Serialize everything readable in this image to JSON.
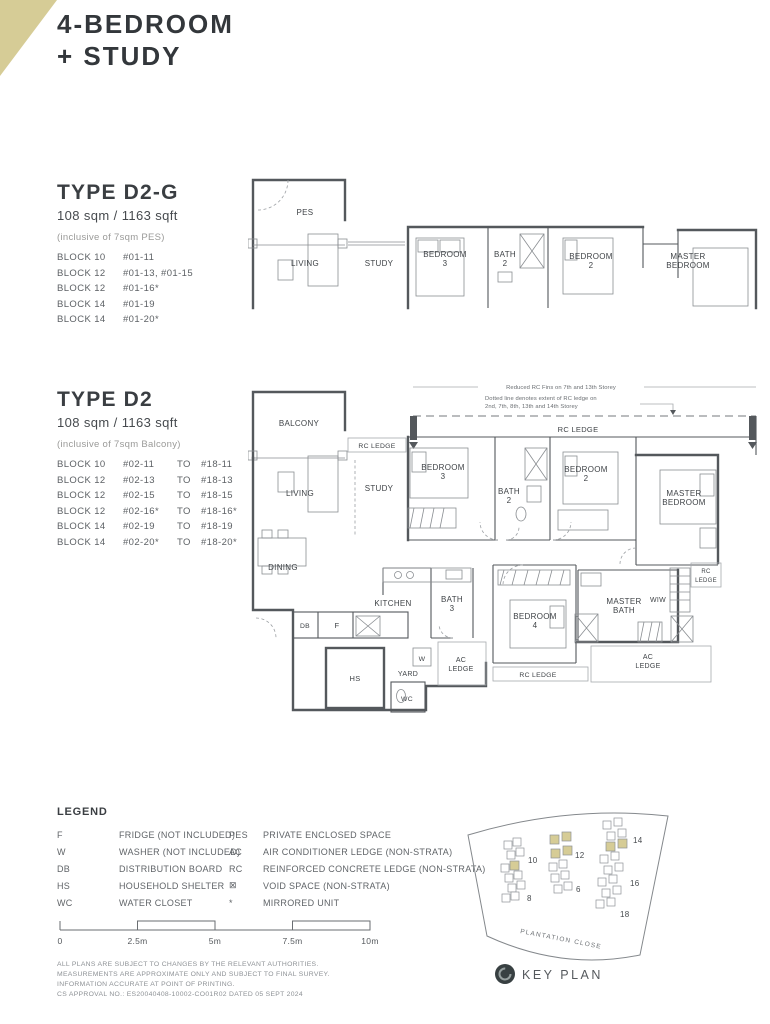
{
  "title": {
    "line1": "4-BEDROOM",
    "line2": "+ STUDY"
  },
  "type_d2g": {
    "name": "TYPE D2-G",
    "area": "108 sqm / 1163 sqft",
    "note": "(inclusive of 7sqm PES)",
    "rows": [
      {
        "block": "BLOCK 10",
        "units": "#01-11"
      },
      {
        "block": "BLOCK 12",
        "units": "#01-13, #01-15"
      },
      {
        "block": "BLOCK 12",
        "units": "#01-16*"
      },
      {
        "block": "BLOCK 14",
        "units": "#01-19"
      },
      {
        "block": "BLOCK 14",
        "units": "#01-20*"
      }
    ]
  },
  "type_d2": {
    "name": "TYPE D2",
    "area": "108 sqm / 1163 sqft",
    "note": "(inclusive of 7sqm Balcony)",
    "to_word": "TO",
    "rows": [
      {
        "block": "BLOCK 10",
        "from": "#02-11",
        "to": "#18-11"
      },
      {
        "block": "BLOCK 12",
        "from": "#02-13",
        "to": "#18-13"
      },
      {
        "block": "BLOCK 12",
        "from": "#02-15",
        "to": "#18-15"
      },
      {
        "block": "BLOCK 12",
        "from": "#02-16*",
        "to": "#18-16*"
      },
      {
        "block": "BLOCK 14",
        "from": "#02-19",
        "to": "#18-19"
      },
      {
        "block": "BLOCK 14",
        "from": "#02-20*",
        "to": "#18-20*"
      }
    ]
  },
  "plan_d2g": {
    "labels": {
      "pes": "PES",
      "living": "LIVING",
      "study": "STUDY",
      "bedroom3": "BEDROOM 3",
      "bath2": "BATH 2",
      "bedroom2": "BEDROOM 2",
      "master_bedroom": "MASTER BEDROOM"
    }
  },
  "plan_d2": {
    "annotations": {
      "fins": "Reduced RC Fins on 7th and 13th Storey",
      "dotted1": "Dotted line denotes extent of RC ledge on",
      "dotted2": "2nd, 7th, 8th, 13th and 14th Storey"
    },
    "labels": {
      "rc_ledge_top": "RC LEDGE",
      "balcony": "BALCONY",
      "rc_ledge_balcony": "RC LEDGE",
      "living": "LIVING",
      "study": "STUDY",
      "dining": "DINING",
      "kitchen": "KITCHEN",
      "bath3": "BATH 3",
      "bedroom3": "BEDROOM 3",
      "bath2": "BATH 2",
      "bedroom2": "BEDROOM 2",
      "master_bedroom": "MASTER BEDROOM",
      "bedroom4": "BEDROOM 4",
      "master_bath": "MASTER BATH",
      "wiw": "WIW",
      "rc_ledge_right": "RC LEDGE",
      "rc_ledge_bottom": "RC LEDGE",
      "ac_ledge_mid": "AC LEDGE",
      "ac_ledge_right": "AC LEDGE",
      "db": "DB",
      "f": "F",
      "hs": "HS",
      "w": "W",
      "wc": "WC",
      "yard": "YARD"
    }
  },
  "legend": {
    "title": "LEGEND",
    "col1": [
      {
        "abbr": "F",
        "desc": "FRIDGE (NOT INCLUDED)"
      },
      {
        "abbr": "W",
        "desc": "WASHER (NOT INCLUDED)"
      },
      {
        "abbr": "DB",
        "desc": "DISTRIBUTION BOARD"
      },
      {
        "abbr": "HS",
        "desc": "HOUSEHOLD SHELTER"
      },
      {
        "abbr": "WC",
        "desc": "WATER CLOSET"
      }
    ],
    "col2": [
      {
        "abbr": "PES",
        "desc": "PRIVATE ENCLOSED SPACE"
      },
      {
        "abbr": "AC",
        "desc": "AIR CONDITIONER LEDGE (NON-STRATA)"
      },
      {
        "abbr": "RC",
        "desc": "REINFORCED CONCRETE LEDGE (NON-STRATA)"
      },
      {
        "abbr": "⊠",
        "desc": "VOID SPACE (NON-STRATA)"
      },
      {
        "abbr": "*",
        "desc": "MIRRORED UNIT"
      }
    ]
  },
  "scalebar": {
    "ticks": [
      "0",
      "2.5m",
      "5m",
      "7.5m",
      "10m"
    ]
  },
  "disclaimer": {
    "line1": "ALL PLANS ARE SUBJECT TO CHANGES BY THE RELEVANT AUTHORITIES.",
    "line2": "MEASUREMENTS ARE APPROXIMATE ONLY AND SUBJECT TO FINAL SURVEY.",
    "line3": "INFORMATION ACCURATE AT POINT OF PRINTING.",
    "line4": "CS APPROVAL NO.: ES20040408-10002-CO01R02 DATED 05 SEPT 2024"
  },
  "keyplan": {
    "street": "PLANTATION CLOSE",
    "label": "KEY PLAN",
    "blocks": {
      "b10": "10",
      "b8": "8",
      "b12": "12",
      "b6": "6",
      "b14": "14",
      "b16": "16",
      "b18": "18"
    },
    "highlight_color": "#d6cc96"
  },
  "colors": {
    "accent_beige": "#d6cc96",
    "wall": "#54585c",
    "text_dark": "#33373b"
  }
}
